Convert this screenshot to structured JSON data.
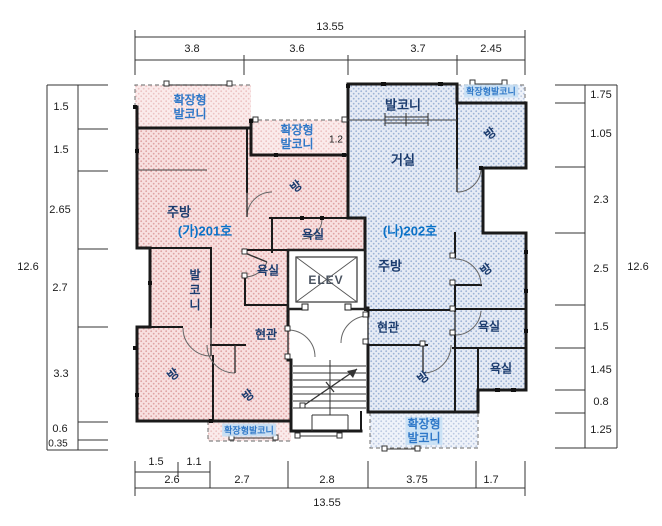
{
  "dims": {
    "top_total": "13.55",
    "top": [
      "3.8",
      "3.6",
      "3.7",
      "2.45"
    ],
    "bottom_total": "13.55",
    "bottom": [
      "2.6",
      "2.7",
      "2.8",
      "3.75",
      "1.7"
    ],
    "bottom_sub": [
      "1.5",
      "1.1"
    ],
    "left_total": "12.6",
    "left": [
      "1.5",
      "1.5",
      "2.65",
      "2.7",
      "3.3",
      "0.6",
      "0.35"
    ],
    "right_total": "12.6",
    "right": [
      "1.75",
      "1.05",
      "2.3",
      "2.5",
      "1.5",
      "1.45",
      "0.8",
      "1.25"
    ],
    "inner_balcony_width": "1.2"
  },
  "unit1": {
    "id": "(가)201호",
    "kitchen": "주방",
    "room_top": "방",
    "bath_upper": "욕실",
    "bath_inner": "욕실",
    "rear_balcony": "발코니",
    "entry": "현관",
    "room_bottom_left": "방",
    "room_bottom_center": "방",
    "ext_balcony_line1": "확장형",
    "ext_balcony_line2": "발코니",
    "ext_balcony_small": "확장형발코니"
  },
  "unit2": {
    "id": "(나)202호",
    "living": "거실",
    "front_balcony": "발코니",
    "kitchen": "주방",
    "room_top_right": "방",
    "room_right": "방",
    "room_bottom": "방",
    "bath_upper": "욕실",
    "bath_lower": "욕실",
    "entry": "현관",
    "ext_balcony_small": "확장형발코니",
    "ext_balcony_line1": "확장형",
    "ext_balcony_line2": "발코니"
  },
  "core": {
    "elevator_label": "ELEV"
  },
  "colors": {
    "unit1_fill": "#f8e0e0",
    "unit1_dot": "#dfa3a3",
    "unit2_fill": "#e6ebf5",
    "unit2_dot": "#9db3d6",
    "label_navy": "#1c3c6e",
    "label_blue": "#0a72c8",
    "ext_blue": "#2f78c8",
    "highlight": "#c5dff4",
    "wall": "#1a1a1a"
  }
}
